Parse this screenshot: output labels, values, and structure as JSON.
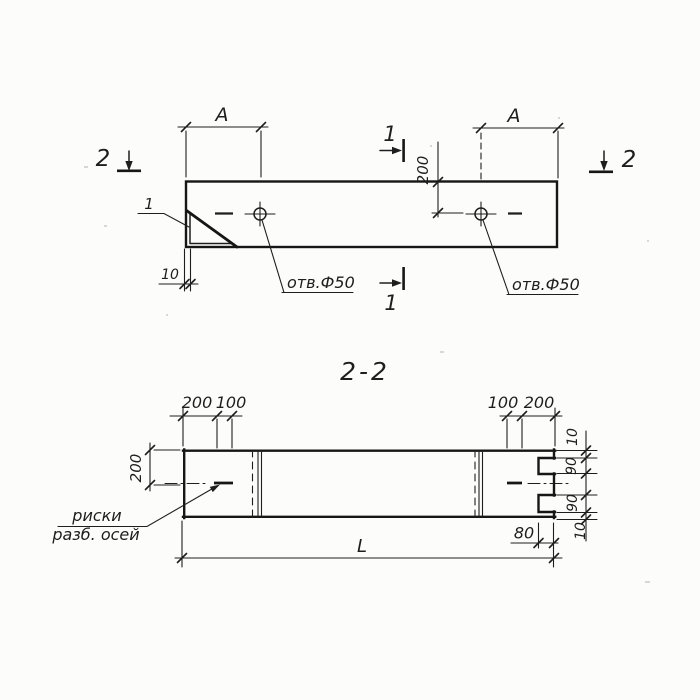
{
  "colors": {
    "ink": "#1e1e1e",
    "paper": "#fcfcfb"
  },
  "plan_view": {
    "dim_a_left": "A",
    "dim_a_right": "A",
    "dim_depth": "200",
    "dim_wall": "10",
    "detail_ref": "1",
    "section2_left": "2",
    "section2_right": "2",
    "section1_top": "1",
    "section1_bottom": "1",
    "hole_label_left": "отв.Ф50",
    "hole_label_right": "отв.Ф50"
  },
  "section_view": {
    "title": "2-2",
    "dims_top_left": [
      "200",
      "100"
    ],
    "dims_top_right": [
      "100",
      "200"
    ],
    "dim_height": "200",
    "dims_right": [
      "10",
      "90",
      "90",
      "10"
    ],
    "dim_notch": "80",
    "dim_length": "L",
    "axis_label_line1": "риски",
    "axis_label_line2": "разб. осей"
  }
}
